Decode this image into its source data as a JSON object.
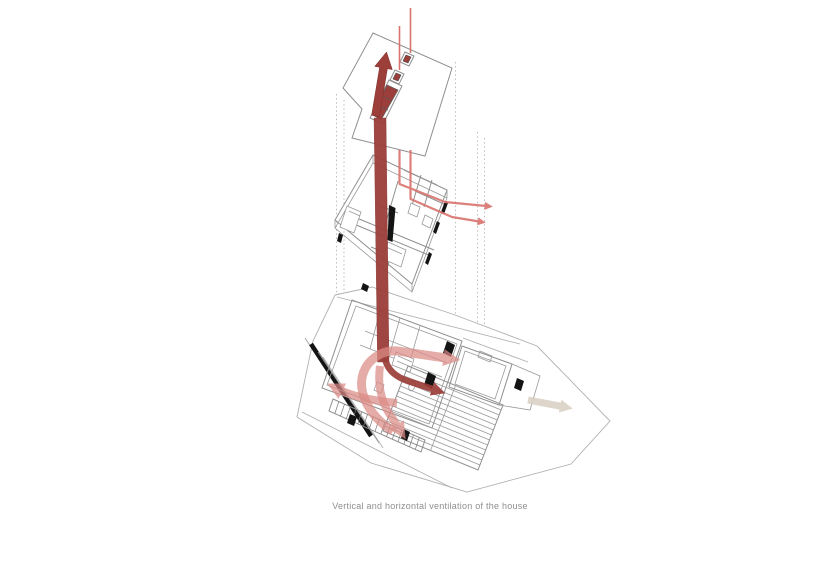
{
  "figure": {
    "caption": "Vertical and horizontal ventilation of the house"
  },
  "colors": {
    "background": "#ffffff",
    "duct_dark_red": "#9c3e39",
    "duct_dark_red_edge": "#7f302c",
    "airflow_light_red": "#dc8b86",
    "pipe_red": "#d9736d",
    "terrace_tan": "#d9d0c2",
    "linework_gray": "#8f8f8f",
    "linework_faint_gray": "#b0b0b0",
    "opening_black": "#141414",
    "caption_gray": "#8f8f8f"
  },
  "flows": {
    "vertical_exhaust": "exhaust-arrow-up-icon",
    "vent_stack_left": "vent-stack-line-left",
    "vent_stack_right": "vent-stack-line-right",
    "upper_floor_supply": "pipe-arrow-right-icon",
    "crossflow_right": "airflow-arrow-right-icon",
    "crossflow_left": "airflow-arrow-left-icon",
    "downdraft": "airflow-arrow-down-icon",
    "branch_dark": "airflow-arrow-branch-icon",
    "terrace_flow": "terrace-arrow-right-icon"
  }
}
